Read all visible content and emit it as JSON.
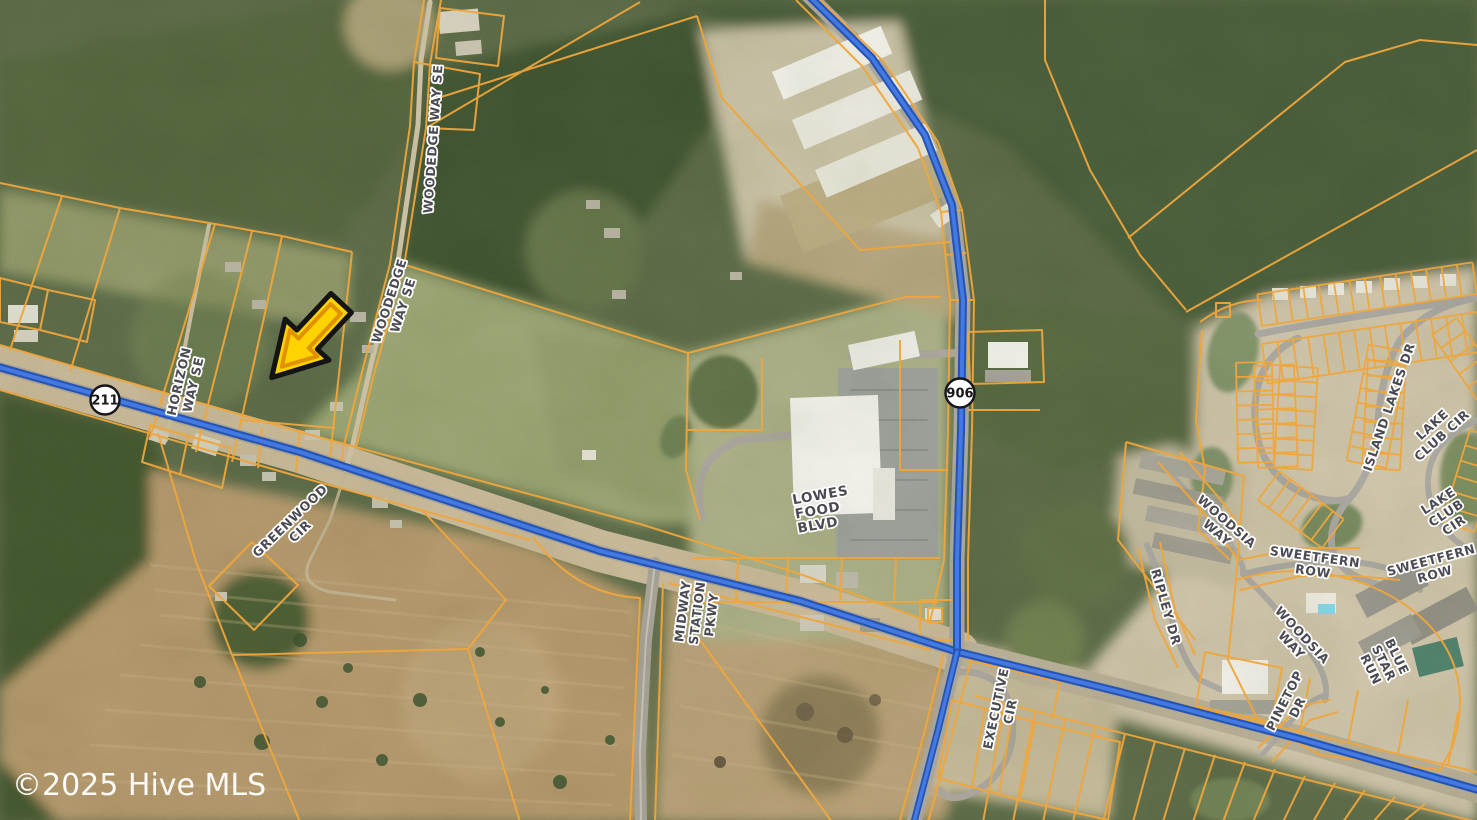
{
  "map": {
    "attribution": "©2025 Hive MLS",
    "highway_shields": [
      {
        "name": "shield-211",
        "route": "211",
        "x": 105,
        "y": 400
      },
      {
        "name": "shield-906",
        "route": "906",
        "x": 960,
        "y": 393
      }
    ],
    "road_labels": [
      {
        "name": "woodedge-way-se-north",
        "lines": [
          "WOODEDGE WAY SE"
        ],
        "x": 433,
        "y": 139,
        "rotation": -86,
        "size": 12.5
      },
      {
        "name": "woodedge-way-se-south",
        "lines": [
          "WOODEDGE",
          "WAY SE"
        ],
        "x": 396,
        "y": 303,
        "rotation": -72,
        "size": 12.5
      },
      {
        "name": "horizon-way-se",
        "lines": [
          "HORIZON",
          "WAY SE"
        ],
        "x": 186,
        "y": 383,
        "rotation": -77,
        "size": 12.5
      },
      {
        "name": "greenwood-cir",
        "lines": [
          "GREENWOOD",
          "CIR"
        ],
        "x": 295,
        "y": 526,
        "rotation": -44,
        "size": 12.5
      },
      {
        "name": "lowes-food-blvd",
        "lines": [
          "LOWES",
          "FOOD",
          "BLVD"
        ],
        "x": 795,
        "y": 514,
        "rotation": -10,
        "size": 13.5,
        "align": "start"
      },
      {
        "name": "midway-station-pkwy",
        "lines": [
          "MIDWAY",
          "STATION",
          "PKWY"
        ],
        "x": 697,
        "y": 613,
        "rotation": -83,
        "size": 12.5
      },
      {
        "name": "executive-cir",
        "lines": [
          "EXECUTIVE",
          "CIR"
        ],
        "x": 1003,
        "y": 710,
        "rotation": -78,
        "size": 12.5
      },
      {
        "name": "ripley-dr",
        "lines": [
          "RIPLEY DR"
        ],
        "x": 1166,
        "y": 607,
        "rotation": 74,
        "size": 12.5
      },
      {
        "name": "woodsia-way-north",
        "lines": [
          "WOODSIA",
          "WAY"
        ],
        "x": 1222,
        "y": 527,
        "rotation": 41,
        "size": 12.5
      },
      {
        "name": "sweetfern-row-west",
        "lines": [
          "SWEETFERN",
          "ROW"
        ],
        "x": 1314,
        "y": 564,
        "rotation": 8,
        "size": 12.5
      },
      {
        "name": "woodsia-way-south",
        "lines": [
          "WOODSIA",
          "WAY"
        ],
        "x": 1297,
        "y": 640,
        "rotation": 47,
        "size": 12.5
      },
      {
        "name": "island-lakes-dr",
        "lines": [
          "ISLAND LAKES DR"
        ],
        "x": 1389,
        "y": 407,
        "rotation": -71,
        "size": 12.5
      },
      {
        "name": "lake-club-cir-north",
        "lines": [
          "LAKE",
          "CLUB CIR"
        ],
        "x": 1437,
        "y": 430,
        "rotation": -42,
        "size": 12.5
      },
      {
        "name": "lake-club-cir-south",
        "lines": [
          "LAKE",
          "CLUB",
          "CIR"
        ],
        "x": 1446,
        "y": 513,
        "rotation": -33,
        "size": 12.5
      },
      {
        "name": "sweetfern-row-east",
        "lines": [
          "SWEETFERN",
          "ROW"
        ],
        "x": 1433,
        "y": 567,
        "rotation": -15,
        "size": 12.5
      },
      {
        "name": "blue-star-run",
        "lines": [
          "BLUE",
          "STAR",
          "RUN"
        ],
        "x": 1384,
        "y": 663,
        "rotation": 64,
        "size": 12.5
      },
      {
        "name": "pinetop-dr",
        "lines": [
          "PINETOP",
          "DR"
        ],
        "x": 1291,
        "y": 704,
        "rotation": -63,
        "size": 12.5
      }
    ],
    "marker": {
      "name": "subject-property-arrow",
      "x": 303,
      "y": 344,
      "rotation": 43,
      "fill": "#ffd300",
      "bevel": "#e09200",
      "outline": "#141414"
    },
    "colors": {
      "parcel_line": "#f0a63c",
      "highway_casing": "#2353b4",
      "highway_fill": "#4379e0",
      "label_text": "#4b4b54",
      "label_halo": "#ffffff",
      "shield_fill": "#ffffff",
      "shield_border": "#15151a"
    }
  }
}
